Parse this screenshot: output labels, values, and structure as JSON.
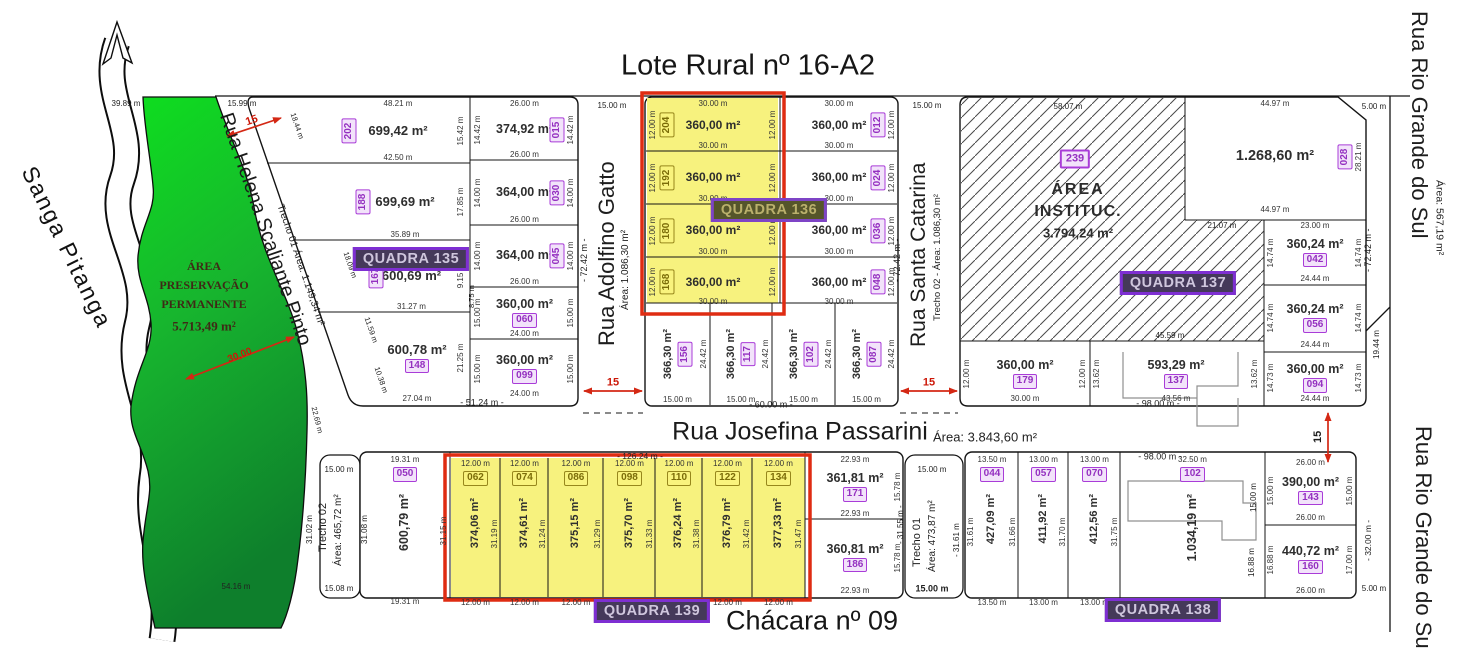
{
  "title": "Lote Rural nº 16-A2",
  "chacara": "Chácara nº 09",
  "stream": {
    "name": "Sanga Pitanga"
  },
  "preservation": {
    "line1": "ÁREA",
    "line2": "PRESERVAÇÃO",
    "line3": "PERMANENTE",
    "area": "5.713,49 m²"
  },
  "institutional": {
    "id": "239",
    "line1": "ÁREA",
    "line2": "INSTITUC.",
    "area": "3.794,24 m²"
  },
  "quadras": {
    "q135": "QUADRA 135",
    "q136": "QUADRA 136",
    "q137": "QUADRA 137",
    "q138": "QUADRA 138",
    "q139": "QUADRA 139"
  },
  "streets": {
    "helena": {
      "name": "Rua Helena Scaliante Pinto",
      "detail": "Trecho 01 Área: 1.149,34 m²"
    },
    "adolfino": {
      "name": "Rua Adolfino Gatto",
      "area": "Área: 1.086,30 m²",
      "length": "- 72.42 m -",
      "width": "15.00 m"
    },
    "santa_catarina": {
      "name": "Rua Santa Catarina",
      "detail": "Trecho 02 - Área: 1.086,30 m²",
      "length": "- 72.42 m -",
      "width": "15.00 m"
    },
    "josefina": {
      "name": "Rua Josefina Passarini",
      "area": "Área: 3.843,60 m²"
    },
    "rio_grande": {
      "name": "Rua Rio Grande do Sul",
      "area": "Área: 567,19 m²"
    },
    "trecho02": {
      "name": "Trecho 02",
      "area": "Área: 465,72 m²",
      "top": "15.00 m",
      "bottom": "15.08 m",
      "left": "31.02 m",
      "right": "31.08 m"
    },
    "trecho01": {
      "name": "Trecho 01",
      "area": "Área: 473,87 m²",
      "top": "15.00 m",
      "bottom": "15.00 m",
      "right": "- 31.61 m"
    }
  },
  "labels": {
    "d3989": "39.89 m",
    "d5416": "54.16 m",
    "d3000": "30,00",
    "d1599": "15.99 m",
    "d1844": "18.44 m",
    "d1809": "18.09 m",
    "d1159": "11.59 m",
    "d1038": "10.38 m",
    "d2269": "22.69 m",
    "d875": "8.75 m",
    "r15": "15",
    "t5124": "- 51.24 m -",
    "t6000": "- 60.00 m -",
    "t9800": "- 98.00 m -",
    "t12624": "- 126.24 m -",
    "t7242": "- 72.42 m -",
    "d5807": "58.07 m",
    "d2107": "21.07 m",
    "d4559": "45.59 m",
    "d500": "5.00 m",
    "d1944": "19.44 m",
    "d3155": "- 31.55 m -",
    "t3200": "- 32.00 m -",
    "d1500": "15.00 m",
    "d1688": "16.88 m"
  },
  "lots": {
    "l202": {
      "id": "202",
      "area": "699,42 m²",
      "t": "48.21 m",
      "b": "42.50 m",
      "r": "15.42 m"
    },
    "l188": {
      "id": "188",
      "area": "699,69 m²",
      "b": "35.89 m",
      "r": "17.85 m"
    },
    "l167": {
      "id": "167",
      "area": "600,69 m²",
      "b": "31.27 m",
      "r": "9.15 m"
    },
    "l148": {
      "id": "148",
      "area": "600,78 m²",
      "b": "27.04 m",
      "r": "21.25 m"
    },
    "l015": {
      "id": "015",
      "area": "374,92 m²",
      "t": "26.00 m",
      "b": "26.00 m",
      "l": "14.42 m",
      "r": "14.42 m"
    },
    "l030": {
      "id": "030",
      "area": "364,00 m²",
      "b": "26.00 m",
      "l": "14.00 m",
      "r": "14.00 m"
    },
    "l045": {
      "id": "045",
      "area": "364,00 m²",
      "b": "26.00 m",
      "l": "14.00 m",
      "r": "14.00 m"
    },
    "l060": {
      "id": "060",
      "area": "360,00 m²",
      "b": "24.00 m",
      "l": "15.00 m",
      "r": "15.00 m"
    },
    "l099": {
      "id": "099",
      "area": "360,00 m²",
      "b": "24.00 m",
      "l": "15.00 m",
      "r": "15.00 m"
    },
    "l204": {
      "id": "204",
      "area": "360,00 m²",
      "t": "30.00 m",
      "b": "30.00 m",
      "l": "12.00 m",
      "r": "12.00 m"
    },
    "l192": {
      "id": "192",
      "area": "360,00 m²",
      "b": "30.00 m",
      "l": "12.00 m",
      "r": "12.00 m"
    },
    "l180": {
      "id": "180",
      "area": "360,00 m²",
      "b": "30.00 m",
      "l": "12.00 m",
      "r": "12.00 m"
    },
    "l168": {
      "id": "168",
      "area": "360,00 m²",
      "b": "30.00 m",
      "l": "12.00 m",
      "r": "12.00 m"
    },
    "l012": {
      "id": "012",
      "area": "360,00 m²",
      "t": "30.00 m",
      "b": "30.00 m",
      "r": "12.00 m"
    },
    "l024": {
      "id": "024",
      "area": "360,00 m²",
      "b": "30.00 m",
      "r": "12.00 m"
    },
    "l036": {
      "id": "036",
      "area": "360,00 m²",
      "b": "30.00 m",
      "r": "12.00 m"
    },
    "l048": {
      "id": "048",
      "area": "360,00 m²",
      "b": "30.00 m",
      "r": "12.00 m"
    },
    "l156": {
      "id": "156",
      "area": "366,30 m²",
      "b": "15.00 m",
      "r": "24.42 m"
    },
    "l117": {
      "id": "117",
      "area": "366,30 m²",
      "b": "15.00 m",
      "r": "24.42 m"
    },
    "l102a": {
      "id": "102",
      "area": "366,30 m²",
      "b": "15.00 m",
      "r": "24.42 m"
    },
    "l087": {
      "id": "087",
      "area": "366,30 m²",
      "b": "15.00 m",
      "r": "24.42 m"
    },
    "l028": {
      "id": "028",
      "area": "1.268,60 m²",
      "t": "44.97 m",
      "b": "44.97 m",
      "r": "28.21 m"
    },
    "l042": {
      "id": "042",
      "area": "360,24 m²",
      "t": "23.00 m",
      "b": "24.44 m",
      "l": "14.74 m",
      "r": "14.74 m"
    },
    "l056": {
      "id": "056",
      "area": "360,24 m²",
      "b": "24.44 m",
      "l": "14.74 m",
      "r": "14.74 m"
    },
    "l094": {
      "id": "094",
      "area": "360,00 m²",
      "b": "24.44 m",
      "l": "14.73 m",
      "r": "14.73 m"
    },
    "l179": {
      "id": "179",
      "area": "360,00 m²",
      "b": "30.00 m",
      "l": "12.00 m",
      "r": "12.00 m"
    },
    "l137": {
      "id": "137",
      "area": "593,29 m²",
      "b": "43.56 m",
      "l": "13.62 m",
      "r": "13.62 m"
    },
    "l050": {
      "id": "050",
      "area": "600,79 m²",
      "t": "19.31 m",
      "b": "19.31 m",
      "r": "31.15 m"
    },
    "l062": {
      "id": "062",
      "area": "374,06 m²",
      "t": "12.00 m",
      "b": "12.00 m",
      "r": "31.19 m"
    },
    "l074": {
      "id": "074",
      "area": "374,61 m²",
      "t": "12.00 m",
      "b": "12.00 m",
      "r": "31.24 m"
    },
    "l086": {
      "id": "086",
      "area": "375,15 m²",
      "t": "12.00 m",
      "b": "12.00 m",
      "r": "31.29 m"
    },
    "l098": {
      "id": "098",
      "area": "375,70 m²",
      "t": "12.00 m",
      "b": "12.00 m",
      "r": "31.33 m"
    },
    "l110": {
      "id": "110",
      "area": "376,24 m²",
      "t": "12.00 m",
      "b": "12.00 m",
      "r": "31.38 m"
    },
    "l122": {
      "id": "122",
      "area": "376,79 m²",
      "t": "12.00 m",
      "b": "12.00 m",
      "r": "31.42 m"
    },
    "l134": {
      "id": "134",
      "area": "377,33 m²",
      "t": "12.00 m",
      "b": "12.00 m",
      "r": "31.47 m"
    },
    "l171": {
      "id": "171",
      "area": "361,81 m²",
      "t": "22.93 m",
      "b": "22.93 m",
      "r": "15.78 m"
    },
    "l186": {
      "id": "186",
      "area": "360,81 m²",
      "b": "22.93 m",
      "r": "15.78 m"
    },
    "l044": {
      "id": "044",
      "area": "427,09 m²",
      "t": "13.50 m",
      "b": "13.50 m",
      "l": "31.61 m",
      "r": "31.66 m"
    },
    "l057": {
      "id": "057",
      "area": "411,92 m²",
      "t": "13.00 m",
      "b": "13.00 m",
      "r": "31.70 m"
    },
    "l070": {
      "id": "070",
      "area": "412,56 m²",
      "t": "13.00 m",
      "b": "13.00 m",
      "r": "31.75 m"
    },
    "l102b": {
      "id": "102",
      "area": "1.034,19 m²",
      "t": "32.50 m",
      "b": "32.50 m"
    },
    "l143": {
      "id": "143",
      "area": "390,00 m²",
      "t": "26.00 m",
      "b": "26.00 m",
      "l": "15.00 m",
      "r": "15.00 m"
    },
    "l160": {
      "id": "160",
      "area": "440,72 m²",
      "b": "26.00 m",
      "l": "16.88 m",
      "r": "17.00 m"
    }
  },
  "colors": {
    "preservation_green": "#12b32a",
    "lot_highlight_yellow": "#f7f27e",
    "highlight_red": "#df2c12",
    "lot_badge_purple": "#a93cd8",
    "quadra_badge_bg": "#45395a",
    "dimension_red": "#d42814"
  }
}
